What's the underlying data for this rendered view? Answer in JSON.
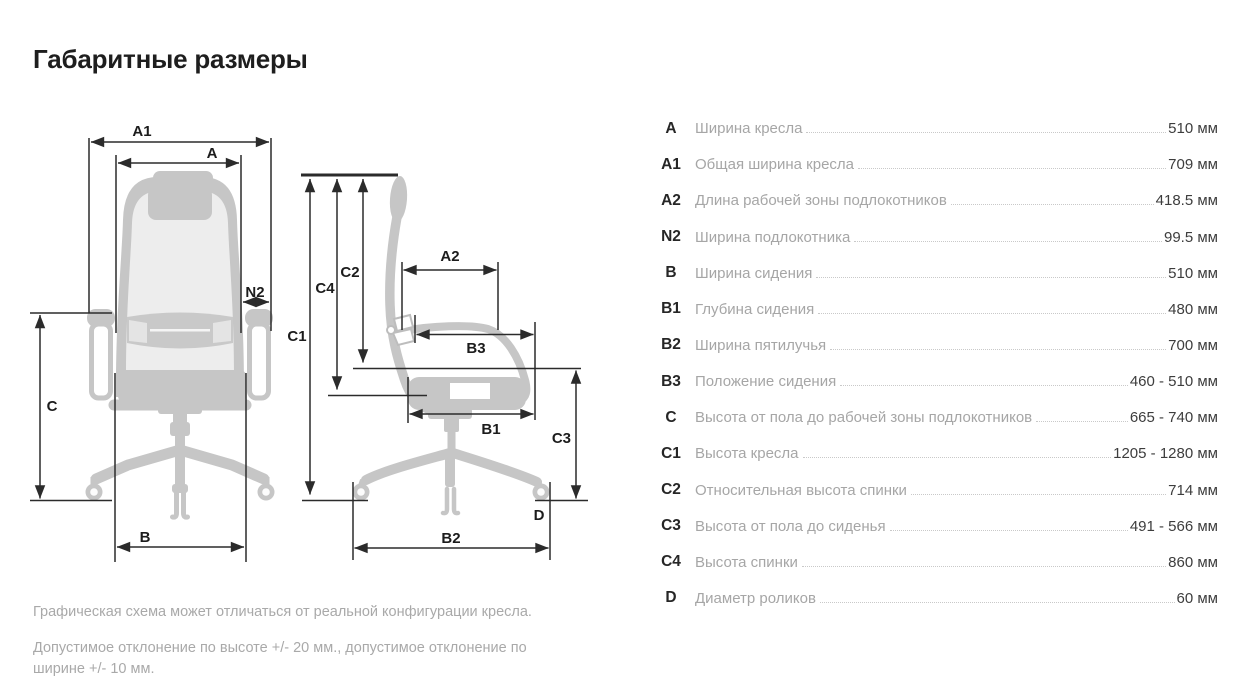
{
  "page": {
    "title": "Габаритные размеры"
  },
  "diagram": {
    "front": {
      "a1": "A1",
      "a": "A",
      "n2": "N2",
      "c": "C",
      "b": "B"
    },
    "side": {
      "c1": "C1",
      "c2": "C2",
      "c4": "C4",
      "a2": "A2",
      "b3": "B3",
      "b1": "B1",
      "c3": "C3",
      "d": "D",
      "b2": "B2"
    }
  },
  "spec_table": {
    "rows": [
      {
        "code": "A",
        "label": "Ширина кресла",
        "value": "510 мм"
      },
      {
        "code": "A1",
        "label": "Общая ширина кресла",
        "value": "709 мм"
      },
      {
        "code": "A2",
        "label": "Длина рабочей зоны подлокотников",
        "value": "418.5 мм"
      },
      {
        "code": "N2",
        "label": "Ширина подлокотника",
        "value": "99.5 мм"
      },
      {
        "code": "B",
        "label": "Ширина сидения",
        "value": "510 мм"
      },
      {
        "code": "B1",
        "label": "Глубина сидения",
        "value": "480 мм"
      },
      {
        "code": "B2",
        "label": "Ширина пятилучья",
        "value": "700 мм"
      },
      {
        "code": "B3",
        "label": "Положение сидения",
        "value": "460 - 510 мм"
      },
      {
        "code": "C",
        "label": "Высота от пола до рабочей зоны подлокотников",
        "value": "665 - 740 мм"
      },
      {
        "code": "C1",
        "label": "Высота кресла",
        "value": "1205 - 1280 мм"
      },
      {
        "code": "C2",
        "label": "Относительная высота спинки",
        "value": "714 мм"
      },
      {
        "code": "C3",
        "label": "Высота от пола до сиденья",
        "value": "491 - 566 мм"
      },
      {
        "code": "C4",
        "label": "Высота спинки",
        "value": "860 мм"
      },
      {
        "code": "D",
        "label": "Диаметр роликов",
        "value": "60 мм"
      }
    ]
  },
  "notes": [
    "Графическая схема может отличаться от реальной конфигурации кресла.",
    "Допустимое отклонение по высоте +/- 20 мм., допустимое отклонение по ширине +/- 10 мм."
  ],
  "colors": {
    "chair_fill": "#c6c6c6",
    "chair_mesh": "#ededed",
    "dimension_line": "#2b2b2b",
    "table_label": "#a6a6a6",
    "table_value": "#3d3d3d"
  }
}
